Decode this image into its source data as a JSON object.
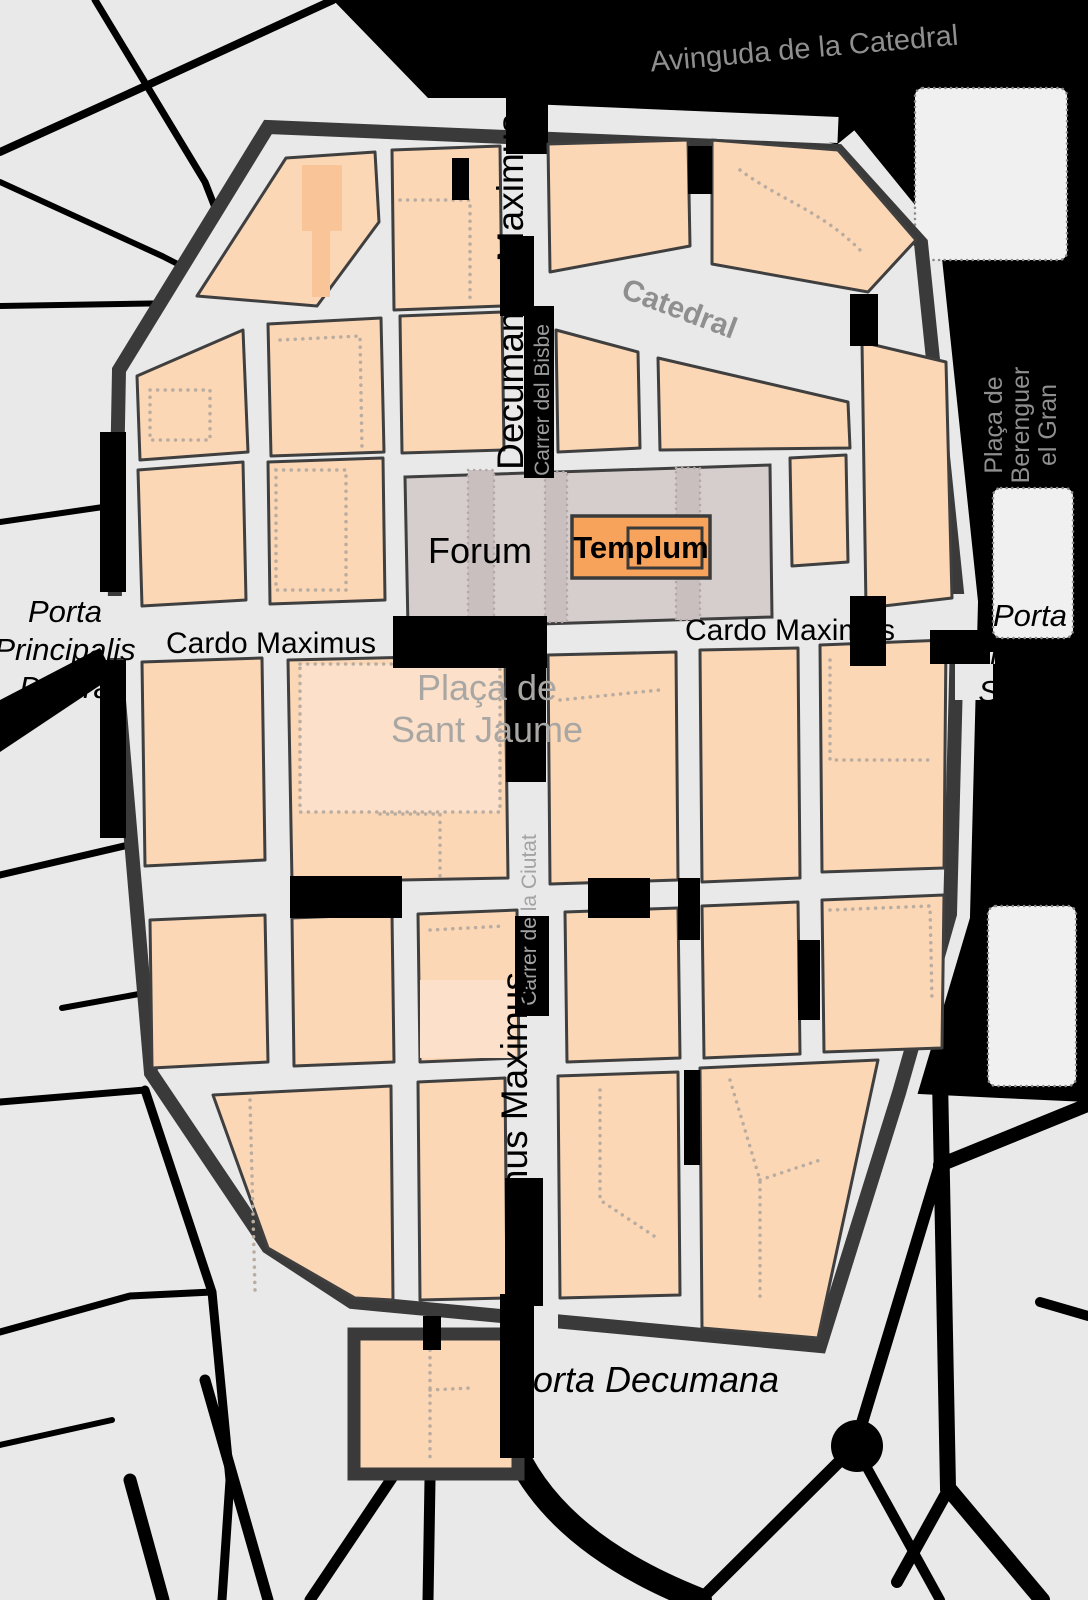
{
  "map": {
    "labels": {
      "avinguda_catedral": "Avinguda de la Catedral",
      "decumanus_top": "Decumanus Maximus",
      "carrer_del_bisbe": "Carrer del Bisbe",
      "catedral": "Catedral",
      "placa_berenguer_line1": "Plaça de",
      "placa_berenguer_line2": "Berenguer",
      "placa_berenguer_line3": "el Gran",
      "forum": "Forum",
      "templum": "Templum",
      "cardo_maximus_left": "Cardo Maximus",
      "cardo_maximus_right": "Cardo Maximus",
      "porta_dextra_line1": "Porta",
      "porta_dextra_line2": "Principalis",
      "porta_dextra_line3": "Dextra",
      "porta_sinistra_line1": "Porta",
      "porta_sinistra_line2": "Principalis",
      "porta_sinistra_line3": "Sinistra",
      "placa_sant_jaume_line1": "Plaça de",
      "placa_sant_jaume_line2": "Sant Jaume",
      "carrer_ciutat": "Carrer de la Ciutat",
      "decumanus_bottom": "Decumanus Maximus",
      "porta_decumana": "Porta Decumana"
    },
    "colors": {
      "background": "#e9e9e9",
      "modern_street": "#000000",
      "roman_wall": "#3a3a3a",
      "insula_fill": "#fcd7b5",
      "insula_stroke": "#3f3f3f",
      "overlay_orange": "#f9c497",
      "overlay_pale": "#fce0c9",
      "overlay_dots": "#b9aca0",
      "forum_fill": "#d6cecd",
      "forum_strip": "#c8bfbe",
      "templum_fill": "#f8a35c",
      "street_name_gray": "#8f8f8f",
      "plaza_name_gray": "#a9a7a4",
      "plaza_panel": "#f0f0f0"
    }
  }
}
